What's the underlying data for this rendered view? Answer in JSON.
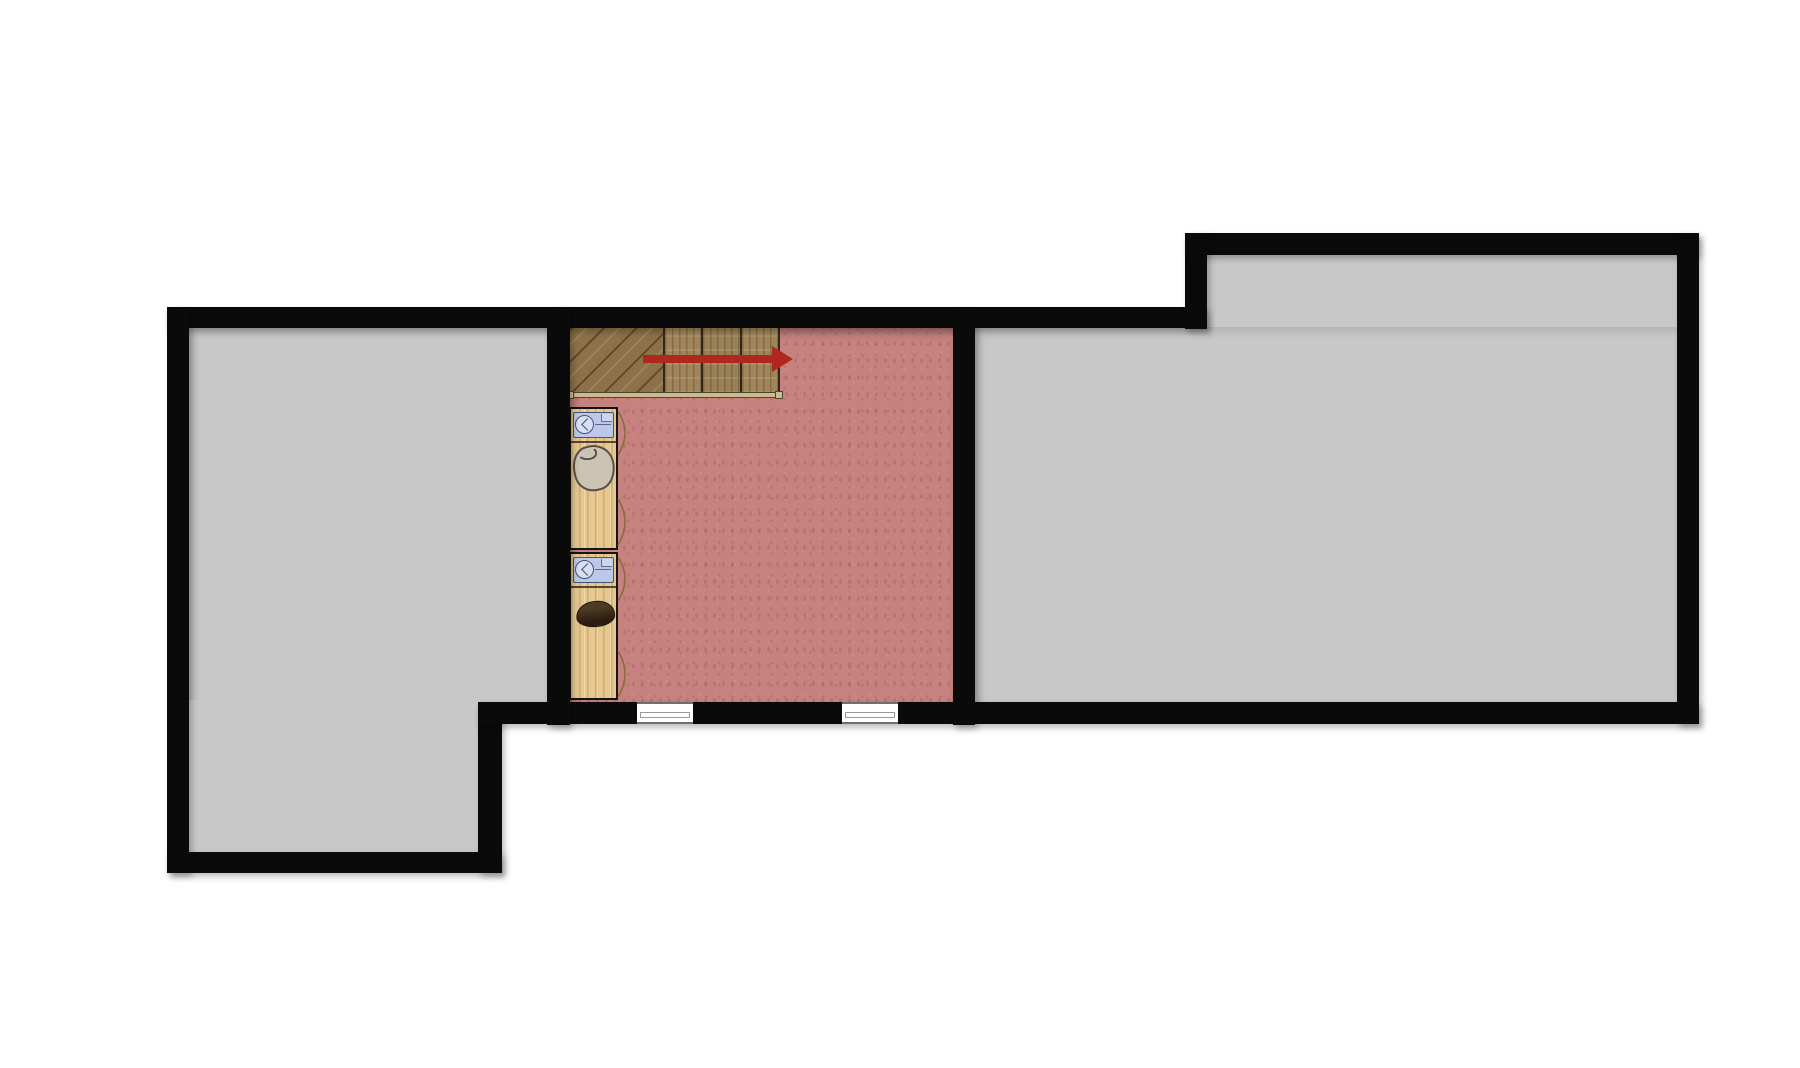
{
  "title": "floor-plan",
  "colors": {
    "wall": "#0a0a0a",
    "floor_gray": "#c8c8c8",
    "floor_pink": "#c6827f",
    "landing_wood": "#8d7148",
    "tread_wood": "#a0855a",
    "rail_wood": "#cdbb8d",
    "cabinet_wood": "#e5c78f",
    "shirt_blue": "#bdc7e9",
    "sweater_gray": "#ccc3b5",
    "hat_brown": "#3c2b1b",
    "arrow_red": "#b0271e",
    "window_white": "#ffffff",
    "window_frame": "#999999"
  },
  "plan": {
    "rooms": [
      {
        "id": "left-room",
        "shape": "L",
        "floor": "gray",
        "furniture": []
      },
      {
        "id": "center-room",
        "shape": "rect",
        "floor": "pink-carpet",
        "furniture": [
          "staircase",
          "wardrobe-1",
          "wardrobe-2"
        ],
        "windows": 2
      },
      {
        "id": "right-room",
        "shape": "notched-rect",
        "floor": "gray",
        "furniture": []
      }
    ],
    "staircase": {
      "landing": true,
      "treads": 3,
      "direction_arrow": "right"
    },
    "wardrobes": [
      {
        "id": "wardrobe-1",
        "items": [
          "shirt",
          "sweater"
        ]
      },
      {
        "id": "wardrobe-2",
        "items": [
          "shirt",
          "hat"
        ]
      }
    ],
    "windows": [
      {
        "id": "window-1"
      },
      {
        "id": "window-2"
      }
    ]
  }
}
